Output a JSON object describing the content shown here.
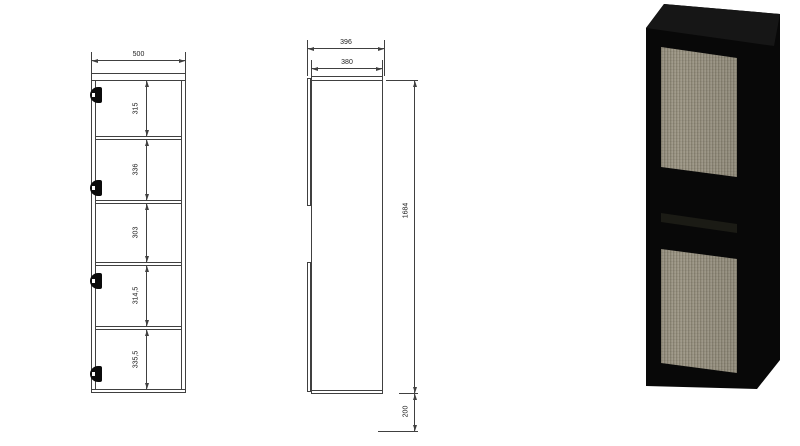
{
  "front_view": {
    "width_label": "500",
    "compartments": [
      {
        "label": "315"
      },
      {
        "label": "336"
      },
      {
        "label": "303"
      },
      {
        "label": "314,5"
      },
      {
        "label": "335,5"
      }
    ]
  },
  "side_view": {
    "outer_depth_label": "396",
    "carcass_depth_label": "380",
    "height_label": "1684",
    "floor_clearance_label": "200"
  },
  "render_3d": {
    "body_color": "#080808",
    "top_face_color": "#161616",
    "panel_color": "#9b9584"
  }
}
